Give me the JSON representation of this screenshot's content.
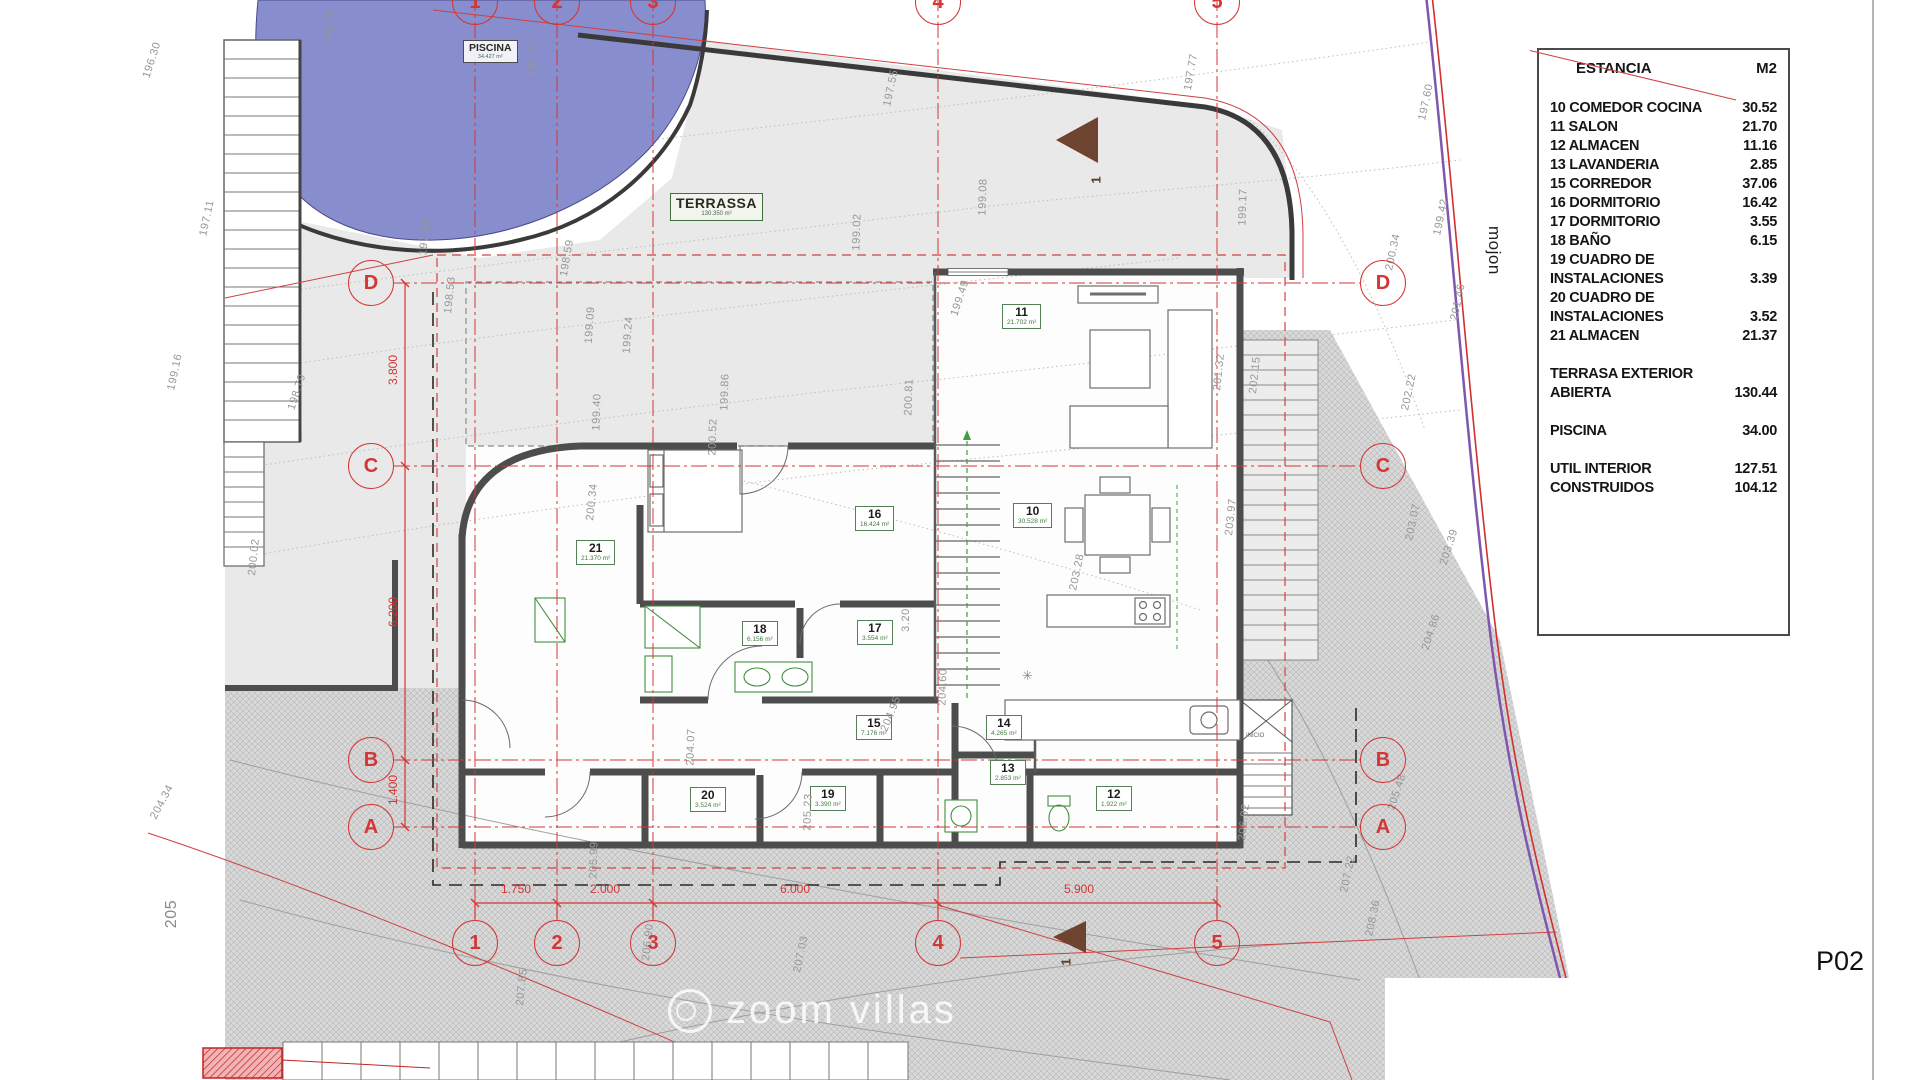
{
  "sheet": {
    "code": "P02"
  },
  "legend": {
    "header": {
      "col1": "ESTANCIA",
      "col2": "M2"
    },
    "rows": [
      {
        "label": "10 COMEDOR COCINA",
        "value": "30.52"
      },
      {
        "label": "11 SALON",
        "value": "21.70"
      },
      {
        "label": "12 ALMACEN",
        "value": "11.16"
      },
      {
        "label": "13 LAVANDERIA",
        "value": "2.85"
      },
      {
        "label": "15 CORREDOR",
        "value": "37.06"
      },
      {
        "label": "16 DORMITORIO",
        "value": "16.42"
      },
      {
        "label": "17 DORMITORIO",
        "value": "3.55"
      },
      {
        "label": "18 BAÑO",
        "value": "6.15"
      },
      {
        "label": "19 CUADRO DE INSTALACIONES",
        "value": "3.39"
      },
      {
        "label": "20 CUADRO DE INSTALACIONES",
        "value": "3.52"
      },
      {
        "label": "21 ALMACEN",
        "value": "21.37"
      },
      {
        "label": "TERRASA EXTERIOR ABIERTA",
        "value": "130.44",
        "gap_before": true
      },
      {
        "label": "PISCINA",
        "value": "34.00",
        "gap_before": true
      },
      {
        "label": "UTIL INTERIOR",
        "value": "127.51",
        "gap_before": true
      },
      {
        "label": "CONSTRUIDOS",
        "value": "104.12"
      }
    ]
  },
  "plan": {
    "pool_label": {
      "name": "PISCINA",
      "area": "34.427 m²"
    },
    "terrace_label": {
      "name": "TERRASSA",
      "area": "130.350 m²"
    },
    "rooms": [
      {
        "number": "10",
        "area": "30.528 m²",
        "x": 1013,
        "y": 503
      },
      {
        "number": "11",
        "area": "21.702 m²",
        "x": 1002,
        "y": 304
      },
      {
        "number": "12",
        "area": "1.922 m²",
        "x": 1096,
        "y": 786
      },
      {
        "number": "13",
        "area": "2.853 m²",
        "x": 990,
        "y": 760
      },
      {
        "number": "14",
        "area": "4.265 m²",
        "x": 986,
        "y": 715
      },
      {
        "number": "15",
        "area": "7.176 m²",
        "x": 856,
        "y": 715
      },
      {
        "number": "16",
        "area": "16.424 m²",
        "x": 855,
        "y": 506
      },
      {
        "number": "17",
        "area": "3.554 m²",
        "x": 857,
        "y": 620
      },
      {
        "number": "18",
        "area": "6.156 m²",
        "x": 742,
        "y": 621
      },
      {
        "number": "19",
        "area": "3.390 m²",
        "x": 810,
        "y": 786
      },
      {
        "number": "20",
        "area": "3.524 m²",
        "x": 690,
        "y": 787
      },
      {
        "number": "21",
        "area": "21.370 m²",
        "x": 576,
        "y": 540
      }
    ],
    "grid": {
      "cols": [
        {
          "label": "1",
          "x": 475
        },
        {
          "label": "2",
          "x": 557
        },
        {
          "label": "3",
          "x": 653
        },
        {
          "label": "4",
          "x": 938
        },
        {
          "label": "5",
          "x": 1217
        }
      ],
      "rows": [
        {
          "label": "D",
          "y": 283
        },
        {
          "label": "C",
          "y": 466
        },
        {
          "label": "B",
          "y": 760
        },
        {
          "label": "A",
          "y": 827
        }
      ],
      "top_bubble_y": 2,
      "bottom_bubble_y": 943,
      "left_bubble_x": 371,
      "right_bubble_x": 1383
    },
    "dimensions": {
      "vertical": [
        {
          "t": "3.800",
          "x": 393,
          "y": 370
        },
        {
          "t": "6.200",
          "x": 393,
          "y": 612
        },
        {
          "t": "1.400",
          "x": 393,
          "y": 790
        }
      ],
      "horizontal": [
        {
          "t": "1.750",
          "x": 516,
          "y": 889
        },
        {
          "t": "2.000",
          "x": 605,
          "y": 889
        },
        {
          "t": "6.000",
          "x": 795,
          "y": 889
        },
        {
          "t": "5.900",
          "x": 1079,
          "y": 889
        }
      ]
    },
    "contour_labels": [
      {
        "t": "196.30",
        "x": 152,
        "y": 60,
        "r": -72
      },
      {
        "t": "197.11",
        "x": 207,
        "y": 218,
        "r": -78
      },
      {
        "t": "196.29",
        "x": 330,
        "y": 28,
        "r": -86
      },
      {
        "t": "196.73",
        "x": 533,
        "y": 58,
        "r": -88
      },
      {
        "t": "197.68",
        "x": 425,
        "y": 237,
        "r": -84
      },
      {
        "t": "198.53",
        "x": 450,
        "y": 295,
        "r": -84
      },
      {
        "t": "198.59",
        "x": 567,
        "y": 258,
        "r": -80
      },
      {
        "t": "199.09",
        "x": 590,
        "y": 325,
        "r": -86
      },
      {
        "t": "199.24",
        "x": 628,
        "y": 335,
        "r": -86
      },
      {
        "t": "199.40",
        "x": 597,
        "y": 412,
        "r": -88
      },
      {
        "t": "199.86",
        "x": 725,
        "y": 392,
        "r": -88
      },
      {
        "t": "200.52",
        "x": 713,
        "y": 437,
        "r": -88
      },
      {
        "t": "200.34",
        "x": 592,
        "y": 502,
        "r": -84
      },
      {
        "t": "200.81",
        "x": 909,
        "y": 397,
        "r": -88
      },
      {
        "t": "197.55",
        "x": 891,
        "y": 88,
        "r": -78
      },
      {
        "t": "199.02",
        "x": 857,
        "y": 232,
        "r": -88
      },
      {
        "t": "199.08",
        "x": 983,
        "y": 197,
        "r": -88
      },
      {
        "t": "199.49",
        "x": 960,
        "y": 298,
        "r": -72
      },
      {
        "t": "197.77",
        "x": 1191,
        "y": 72,
        "r": -80
      },
      {
        "t": "199.17",
        "x": 1243,
        "y": 207,
        "r": -88
      },
      {
        "t": "201.32",
        "x": 1219,
        "y": 372,
        "r": -84
      },
      {
        "t": "202.15",
        "x": 1255,
        "y": 375,
        "r": -84
      },
      {
        "t": "203.28",
        "x": 1077,
        "y": 572,
        "r": -78
      },
      {
        "t": "203.97",
        "x": 1231,
        "y": 517,
        "r": -84
      },
      {
        "t": "204.60",
        "x": 943,
        "y": 687,
        "r": -88
      },
      {
        "t": "204.95",
        "x": 891,
        "y": 714,
        "r": -68
      },
      {
        "t": "204.07",
        "x": 691,
        "y": 747,
        "r": -88
      },
      {
        "t": "205.23",
        "x": 808,
        "y": 812,
        "r": -88
      },
      {
        "t": "205.99",
        "x": 594,
        "y": 860,
        "r": -88
      },
      {
        "t": "204.34",
        "x": 162,
        "y": 802,
        "r": -62
      },
      {
        "t": "205",
        "x": 172,
        "y": 914,
        "r": -90,
        "big": true
      },
      {
        "t": "200.02",
        "x": 254,
        "y": 557,
        "r": -84
      },
      {
        "t": "199.16",
        "x": 175,
        "y": 372,
        "r": -78
      },
      {
        "t": "198.79",
        "x": 297,
        "y": 392,
        "r": -72
      },
      {
        "t": "206.92",
        "x": 1244,
        "y": 822,
        "r": -84
      },
      {
        "t": "207.22",
        "x": 1348,
        "y": 874,
        "r": -78
      },
      {
        "t": "208.36",
        "x": 1373,
        "y": 918,
        "r": -78
      },
      {
        "t": "206.90",
        "x": 648,
        "y": 942,
        "r": -84
      },
      {
        "t": "207.03",
        "x": 801,
        "y": 954,
        "r": -78
      },
      {
        "t": "207.85",
        "x": 522,
        "y": 987,
        "r": -84
      },
      {
        "t": "197.60",
        "x": 1426,
        "y": 102,
        "r": -78
      },
      {
        "t": "199.42",
        "x": 1441,
        "y": 217,
        "r": -78
      },
      {
        "t": "200.34",
        "x": 1393,
        "y": 252,
        "r": -78
      },
      {
        "t": "201.46",
        "x": 1458,
        "y": 302,
        "r": -78
      },
      {
        "t": "202.22",
        "x": 1409,
        "y": 392,
        "r": -78
      },
      {
        "t": "203.07",
        "x": 1413,
        "y": 522,
        "r": -78
      },
      {
        "t": "203.39",
        "x": 1449,
        "y": 547,
        "r": -72
      },
      {
        "t": "204.86",
        "x": 1431,
        "y": 632,
        "r": -72
      },
      {
        "t": "205.48",
        "x": 1397,
        "y": 792,
        "r": -72
      },
      {
        "t": "198.27",
        "x": 1723,
        "y": 70,
        "r": -72
      },
      {
        "t": "3.20",
        "x": 906,
        "y": 620,
        "r": -90
      }
    ],
    "section_markers": [
      {
        "t": "1",
        "x": 1096,
        "y": 180
      },
      {
        "t": "1",
        "x": 1066,
        "y": 962
      }
    ],
    "annotations": {
      "mojon": "mojon",
      "inicio": "INICIO"
    }
  },
  "watermark": {
    "text": "zoom villas"
  },
  "colors": {
    "grid_red": "#d43535",
    "wall_gray": "#4d4d4d",
    "pool_blue": "#888dcd",
    "boundary_purple": "#7e57b0",
    "room_green": "#417a41",
    "terrain_gray": "#d9d9d9"
  }
}
